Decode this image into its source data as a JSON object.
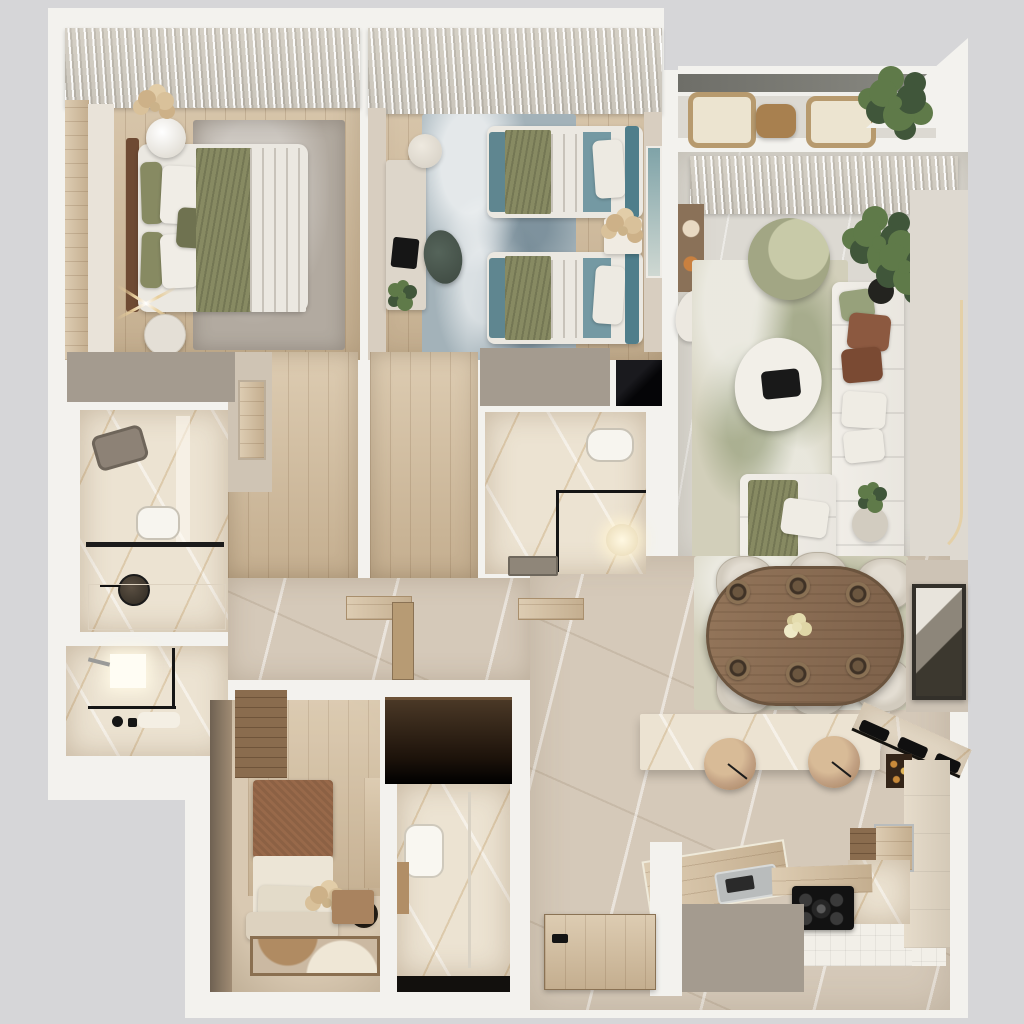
{
  "meta": {
    "kind": "3d-floor-plan-render",
    "view": "top-down",
    "width": 1024,
    "height": 1024,
    "visible_text": ""
  },
  "rooms": [
    {
      "id": "master-bedroom"
    },
    {
      "id": "kids-bedroom"
    },
    {
      "id": "balcony"
    },
    {
      "id": "living-room"
    },
    {
      "id": "dining-area"
    },
    {
      "id": "kitchen"
    },
    {
      "id": "hallway"
    },
    {
      "id": "corridor-master"
    },
    {
      "id": "corridor-kids"
    },
    {
      "id": "bathroom-1"
    },
    {
      "id": "bathroom-2"
    },
    {
      "id": "bathroom-3"
    },
    {
      "id": "bathroom-4"
    },
    {
      "id": "small-bedroom"
    },
    {
      "id": "wardrobe"
    },
    {
      "id": "entry"
    }
  ],
  "palette": {
    "bg": "#d6d6d8",
    "wall": "#f3f2ee",
    "taupe": "#a49b8f",
    "wood": "#c4ae8f",
    "woodLight": "#ddccb2",
    "woodDark": "#8a6c4e",
    "stone": "#dcd9d2",
    "marble": "#d5c9b9",
    "bathMarble": "#ece3d2",
    "tile": "#f2efe8",
    "olive": "#878a62",
    "oliveDark": "#6f7250",
    "bedWhite": "#ebe8e1",
    "rugGray": "#b2aaa0",
    "rugBlue": "#a3b2b9",
    "teal": "#5d8a94",
    "tealDark": "#4f7e8b",
    "tealFoot": "#5f8690",
    "tealSurface": "#7499a3",
    "rugLiving": "#d2cfba",
    "chairGreen": "#a2a684",
    "chairGreenLight": "#c8caa8",
    "sofa": "#e9e6df",
    "rust": "#8c5940",
    "rustDark": "#7a4a33",
    "woodTable": "#8a6e51",
    "tableRim": "#6b543e",
    "chairBeige": "#d2cbbe",
    "island": "#f4ede0",
    "pendant": "#c2a183",
    "pendantDark": "#a37f5c",
    "dark": "#121212",
    "wardrobe": "#241a11",
    "headboardBrown": "#98694a",
    "roomWarm": "#d9c9b2",
    "roomWarmDark": "#b9a88f",
    "doorWood": "#b79b74",
    "steel": "#b9bcbc",
    "artFrame": "#33302a",
    "led": "#e7cd9a",
    "plant": "#5f7a49",
    "plantDark": "#40563a",
    "pampas": "#cbb289",
    "white": "#f1efe9",
    "black": "#0a0a0c",
    "glass": "#151515",
    "wallBeige": "#d8cec0",
    "tvWall": "#ded9d0",
    "panel": "#e9e3d9"
  }
}
